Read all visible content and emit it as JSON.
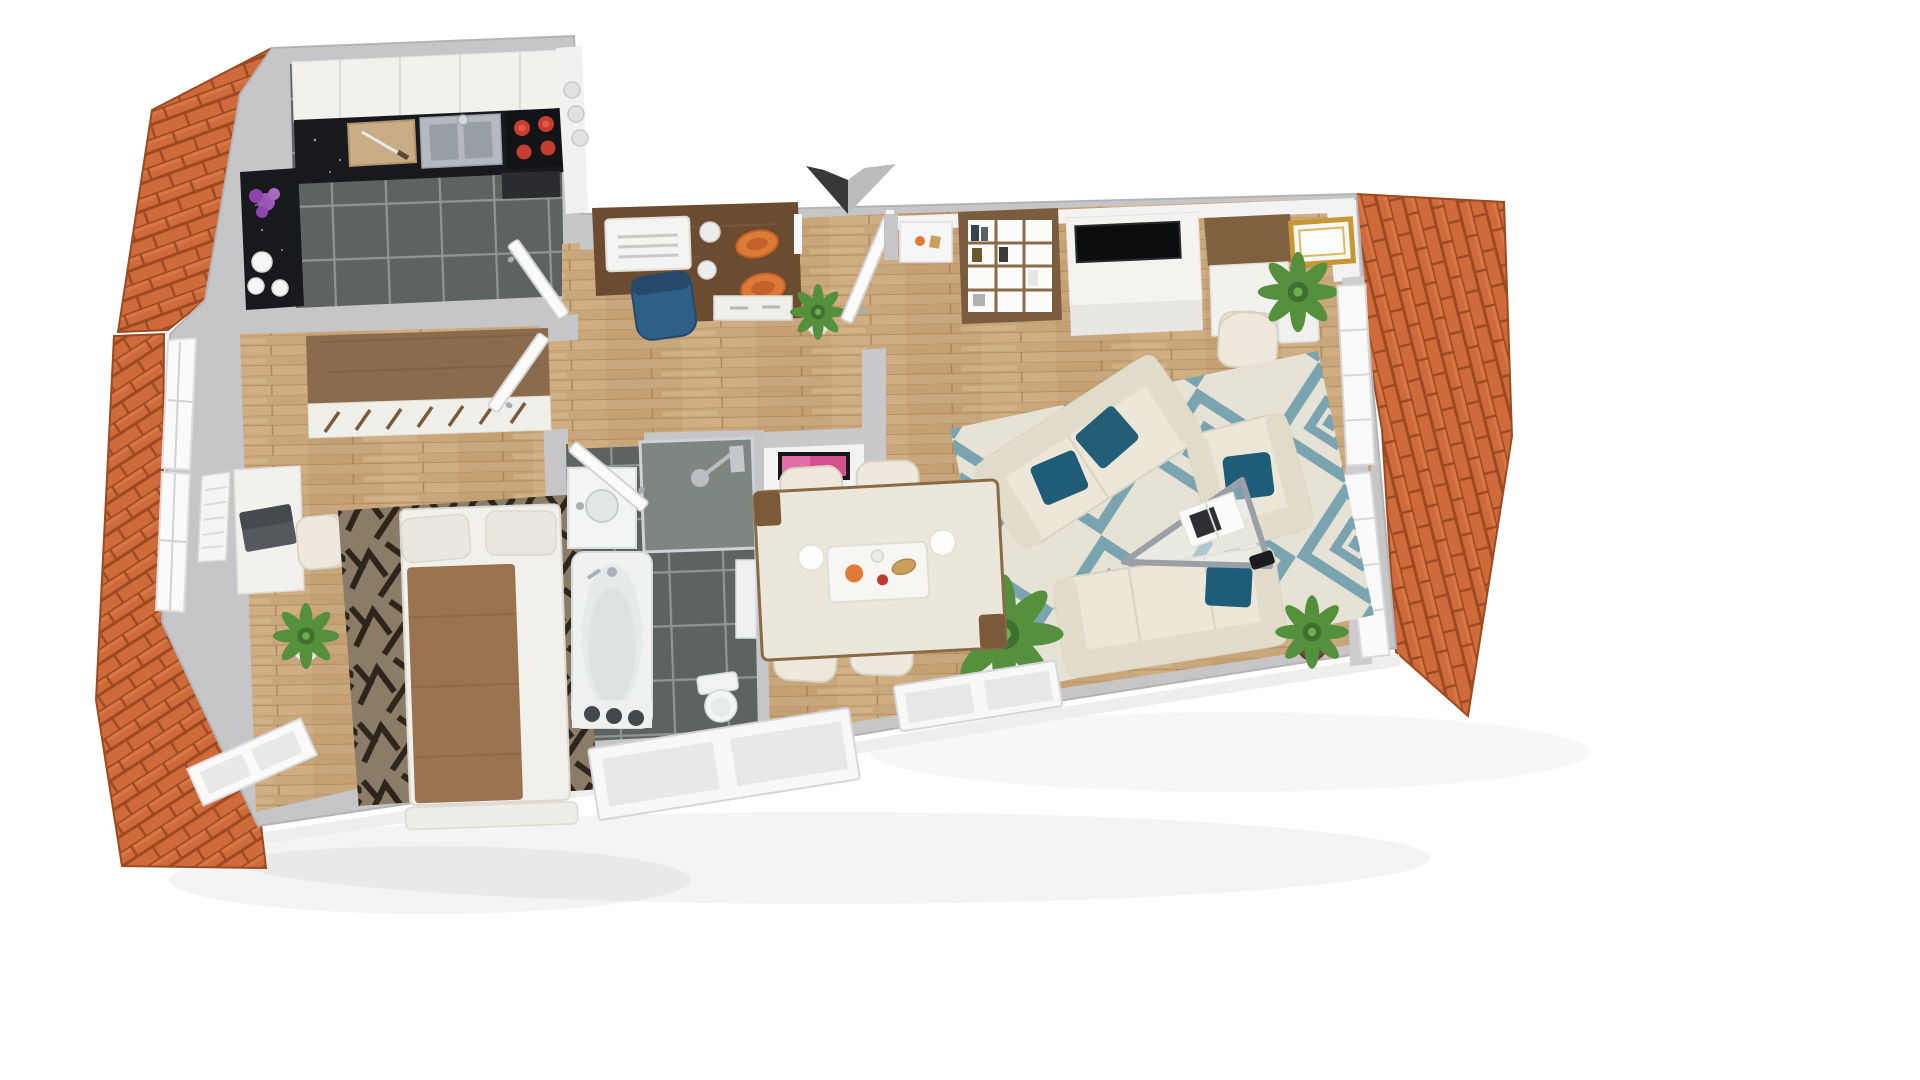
{
  "scene": {
    "kind": "3D floor plan render",
    "view": "top-down bird's-eye of furnished attic apartment",
    "rooms": [
      {
        "name": "kitchen",
        "floor": "dark ceramic tile",
        "items": [
          "upper-cabinet-band",
          "granite-counter",
          "cutting-board",
          "double-sink",
          "ceramic-hob",
          "oven",
          "side-counter",
          "purple-flowers",
          "white-cups",
          "open-door"
        ]
      },
      {
        "name": "bedroom",
        "floor": "oak parquet",
        "items": [
          "wardrobe",
          "desk",
          "laptop",
          "desk-chair",
          "radiator",
          "potted-plant",
          "patterned-rug",
          "double-bed",
          "brown-blanket",
          "pillows",
          "foot-bench",
          "open-door",
          "roof-windows"
        ]
      },
      {
        "name": "hallway",
        "floor": "oak parquet",
        "items": [
          "walnut-sideboard-desk",
          "printer",
          "vases",
          "orange-bowls",
          "blue-chair",
          "potted-plant",
          "entrance-opening",
          "entrance-door",
          "entrance-arrow"
        ]
      },
      {
        "name": "bathroom",
        "floor": "dark ceramic tile",
        "items": [
          "shower",
          "washbasin-vanity",
          "bathtub",
          "toilet",
          "wall-cabinet",
          "open-door"
        ]
      },
      {
        "name": "living-dining-room",
        "floor": "oak parquet",
        "items": [
          "shelving-unit",
          "tv-sideboard",
          "flat-tv",
          "desk",
          "desk-chair",
          "gold-picture-frame",
          "wall-niche-decor",
          "diamond-rug",
          "two-seat-sofa",
          "armchair",
          "three-seat-sofa",
          "teal-cushions",
          "glass-coffee-table",
          "magazine",
          "smartphone",
          "dining-table",
          "dining-chairs",
          "serving-tray",
          "plates",
          "large-potted-plant",
          "small-potted-plant",
          "pink-wall-art",
          "partition-wall",
          "roof-windows",
          "bottom-windows"
        ]
      }
    ],
    "exterior": [
      "tiled-roof-left-upper",
      "tiled-roof-left-lower",
      "tiled-roof-right",
      "white-backdrop",
      "soft-drop-shadow"
    ]
  },
  "palette": {
    "background": "#ffffff",
    "wall": "#c6c6c8",
    "wall_face": "#f3f3f4",
    "roof_tile": "#cf6a3b",
    "roof_tile_dark": "#9c4a22",
    "roof_tile_light": "#e08a55",
    "wood_floor": "#c9a77c",
    "wood_seam": "#ab8358",
    "kitchen_tile": "#5d6360",
    "tile_grout": "#959b96",
    "granite": "#17191d",
    "cabinet": "#f2f1ed",
    "burner_red": "#c43d2f",
    "steel": "#b6bac0",
    "rug_dark_base": "#8b7c68",
    "rug_dark_pattern": "#1f1811",
    "blanket_brown": "#9a7350",
    "linen": "#f2f0ea",
    "wardrobe_wood": "#8a6c4d",
    "walnut": "#6b4c30",
    "chair_blue": "#2e5f86",
    "bowl_orange": "#dd7a35",
    "sofa_cream": "#ece7d9",
    "sofa_shade": "#e2dccb",
    "cushion_teal": "#1f5c78",
    "rug_cream": "#e7e2d6",
    "rug_teal": "#7aa4b0",
    "plant_green": "#55913c",
    "pot_white": "#f0f0ee",
    "frame_gold": "#c69733",
    "art_pink": "#d2518e",
    "arrow_dark": "#38383a",
    "arrow_light": "#bcbcbe",
    "glass_chrome": "#9aa0a5",
    "window_white": "#f8f8f9"
  }
}
